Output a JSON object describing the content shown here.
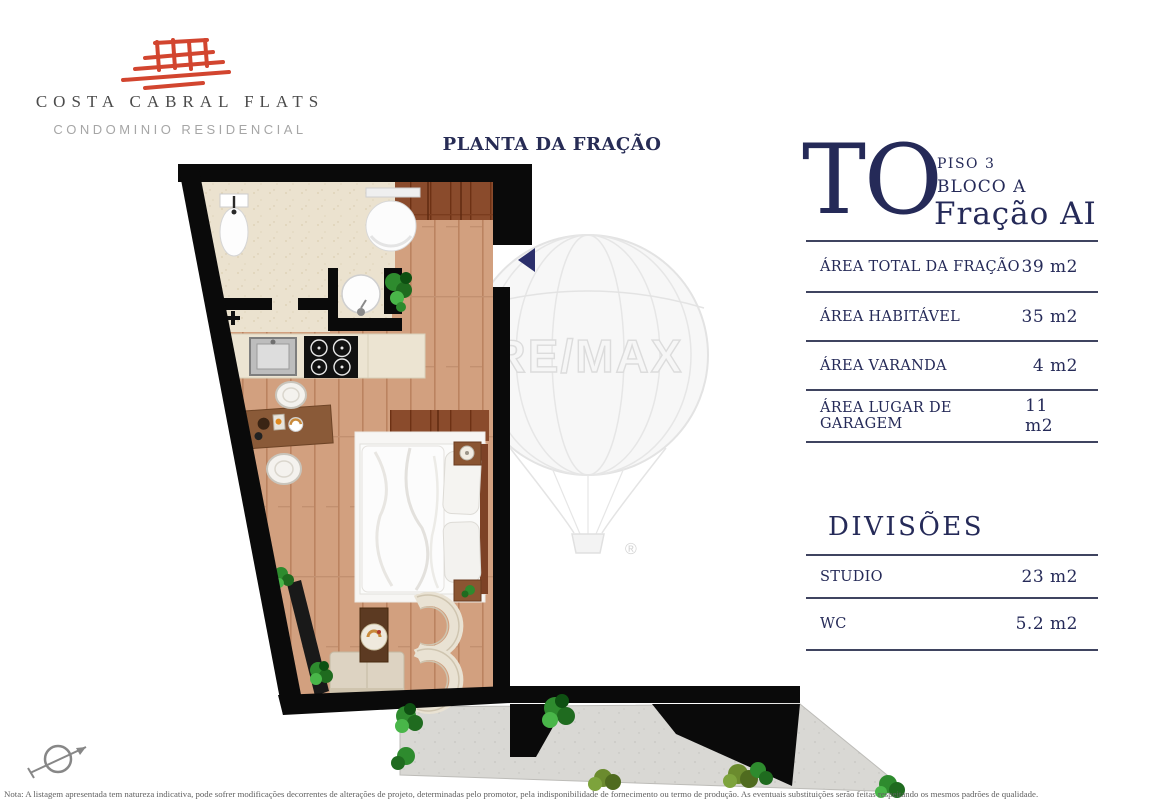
{
  "brand": {
    "name": "COSTA CABRAL FLATS",
    "subtitle": "CONDOMINIO RESIDENCIAL",
    "logo_color": "#d2452f"
  },
  "plan": {
    "title": "PLANTA DA FRAÇÃO",
    "watermark": "RE/MAX",
    "watermark_reg": "®"
  },
  "unit": {
    "code": "TO",
    "floor": "PISO 3",
    "block": "BLOCO A",
    "fraction": "Fração AI"
  },
  "areas": {
    "rows": [
      {
        "label": "ÁREA TOTAL DA FRAÇÃO",
        "value": "39 m2"
      },
      {
        "label": "ÁREA HABITÁVEL",
        "value": "35 m2"
      },
      {
        "label": "ÁREA VARANDA",
        "value": "4 m2"
      },
      {
        "label": "ÁREA LUGAR DE GARAGEM",
        "value": "11 m2"
      }
    ]
  },
  "divisions": {
    "heading": "DIVISÕES",
    "rows": [
      {
        "label": "STUDIO",
        "value": "23 m2"
      },
      {
        "label": "WC",
        "value": "5.2 m2"
      }
    ]
  },
  "footnote": "Nota: A listagem apresentada tem natureza indicativa, pode sofrer modificações decorrentes de alterações de projeto, determinadas pelo promotor, pela indisponibilidade de fornecimento ou termo de produção. As eventuais substituições serão feitas respeitando os mesmos padrões de qualidade.",
  "colors": {
    "navy": "#252a58",
    "logo_red": "#d2452f",
    "wall_black": "#0a0a0a",
    "wood": "#d2a07f",
    "tile": "#ebe2cf"
  }
}
